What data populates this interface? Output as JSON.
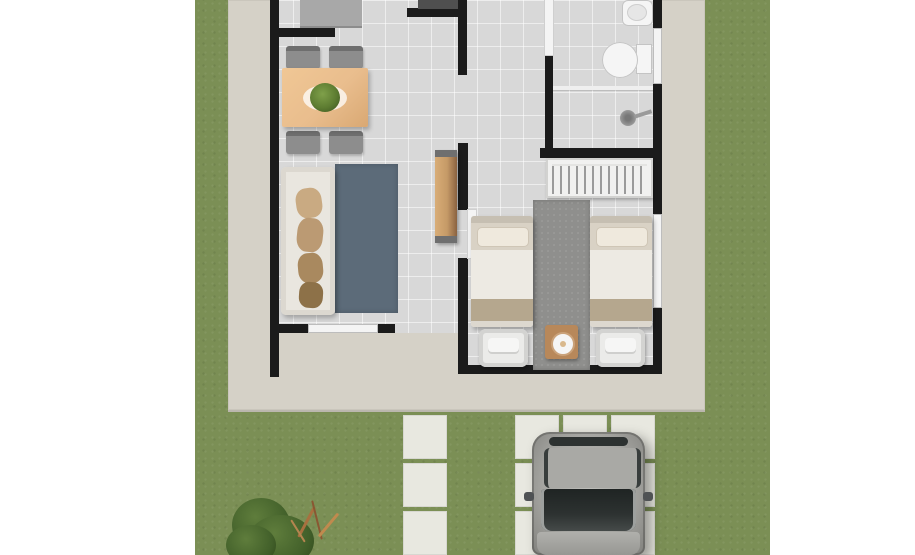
{
  "meta": {
    "description": "Top-down 3D architectural floor plan rendering of a small one-storey house with concrete patio, lawn, paver walkway, driveway and a parked silver car",
    "view": "top-down",
    "media": "rendered image, no visible text",
    "photo_area": {
      "left_px": 195,
      "right_px": 770,
      "note": "white margins on both sides"
    }
  },
  "colors": {
    "page_bg": "#ffffff",
    "grass": "#7b8f55",
    "concrete": "#d5d1c7",
    "floor": "#d8d8d8",
    "wall": "#1b1b1b",
    "window": "#f4f4f4",
    "wood_table": "#e9bd8d",
    "wood_console": "#c59a67",
    "wood_dark": "#8a6240",
    "plant": "#5d7c31",
    "chair_gray": "#8d8d8d",
    "sofa": "#e9e6df",
    "pillow_tan": "#bb9a73",
    "rug_living": "#5c6b79",
    "rug_bedroom": "#8f8f8d",
    "bed_duvet": "#edeae3",
    "bed_pillow": "#d9d2c5",
    "bed_blanket": "#b5a78e",
    "furniture_white": "#ebebe9",
    "nightstand_wood": "#b8885a",
    "fixture_white": "#f5f5f5",
    "fixture_line": "#c4c4c4",
    "metal_gray": "#9a9a9a",
    "car_body": "#a6a6a2",
    "car_glass": "#2d3231",
    "paver": "#e8e8e0",
    "bush_dark": "#42602a",
    "bush_light": "#5f7d3c",
    "twig": "#a8703f"
  },
  "inventory": [
    "lawn",
    "concrete-patio",
    "house-walls",
    "tiled-floor",
    "kitchen-counter",
    "dark-counter",
    "dining-table",
    "table-plant",
    "dining-chair x4",
    "sofa",
    "sofa-pillows x4",
    "living-rug",
    "tv-console",
    "living-window",
    "bathroom-door",
    "bathroom-sink",
    "toilet",
    "shower-partition",
    "shower-head",
    "bathroom-window",
    "wardrobe-with-hangers",
    "bedroom-door",
    "twin-bed x2",
    "bed-foot-chair x2",
    "bedroom-rug",
    "nightstand",
    "table-lamp",
    "bedroom-window",
    "walkway-paver x3",
    "driveway-paver x9",
    "car",
    "garden-bush",
    "dry-twigs"
  ]
}
